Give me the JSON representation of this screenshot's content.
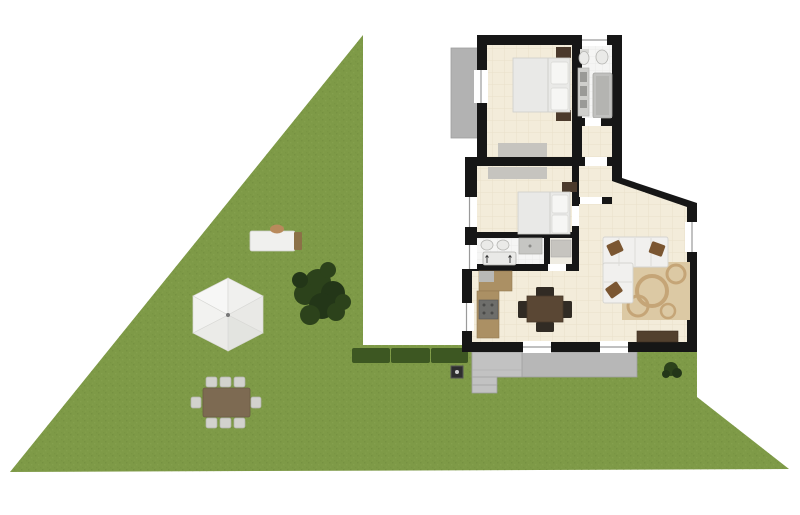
{
  "scene": {
    "type": "floor-plan",
    "description": "Top-down architectural plan of a single-storey house with a large triangular garden on the left",
    "house": {
      "rooms": [
        {
          "name": "bedroom-1",
          "furniture": [
            "double-bed",
            "two-pillows",
            "bedside-tables",
            "wardrobe"
          ]
        },
        {
          "name": "bathroom-1",
          "furniture": [
            "toilet",
            "bidet",
            "vanity-counter",
            "bathtub"
          ]
        },
        {
          "name": "hallway",
          "furniture": []
        },
        {
          "name": "bedroom-2",
          "furniture": [
            "double-bed",
            "two-pillows",
            "bedside-table",
            "wardrobe"
          ]
        },
        {
          "name": "bathroom-2",
          "furniture": [
            "twin-sinks",
            "shower",
            "bathtub"
          ]
        },
        {
          "name": "closet",
          "furniture": [
            "storage-unit"
          ]
        },
        {
          "name": "kitchen-dining",
          "furniture": [
            "l-shaped-counter",
            "stove",
            "square-dining-table",
            "four-chairs"
          ]
        },
        {
          "name": "living-room",
          "furniture": [
            "corner-sofa",
            "three-brown-cushions",
            "patterned-rug",
            "tv-console"
          ]
        }
      ],
      "exterior_features": [
        "balcony",
        "terrace-with-steps",
        "windows",
        "doors"
      ]
    },
    "garden": {
      "shape": "triangular lawn",
      "elements": [
        "gazebo-parasol",
        "large-tree",
        "hedge-row",
        "sun-lounger",
        "outdoor-dining-table-8-chairs",
        "small-bush",
        "well"
      ]
    }
  },
  "colors": {
    "bg": "#ffffff",
    "grass": "#7e9a47",
    "grassSpeckleDark": "#6f8a3c",
    "grassSpeckleLight": "#8aa452",
    "hedge": "#3d5722",
    "tree": "#2c421b",
    "treeDark": "#233618",
    "wall": "#161616",
    "floor": "#f3ecda",
    "tileLine": "#e6ddc6",
    "bathFloor": "#f5f5f4",
    "terrace": "#b7b7b7",
    "terraceLight": "#c2c2c2",
    "terraceEdge": "#9e9e9e",
    "balcony": "#b2b2b2",
    "wardrobe": "#c6c4bf",
    "bedWhite": "#e9e9e7",
    "pillowWhite": "#f6f6f4",
    "headboard": "#4b3a2c",
    "woodCounter": "#ab9064",
    "stove": "#6e6e6b",
    "tableBrown": "#5a4734",
    "chairDark": "#312b24",
    "sofa": "#f1f0ee",
    "sofaLine": "#d5d4d0",
    "pillowBrown": "#7b5631",
    "rug": "#dcc9a4",
    "rugRing": "#c5a577",
    "tvConsole": "#52402e",
    "gazebo": "#f1f1ef",
    "gazeboEdge": "#d9d9d6",
    "loungerWood": "#8b7147",
    "loungerPillow": "#b98a5c",
    "chairLight": "#d2d2cd",
    "windowLine": "#9a9a9a",
    "wellDark": "#2e2e2e"
  }
}
